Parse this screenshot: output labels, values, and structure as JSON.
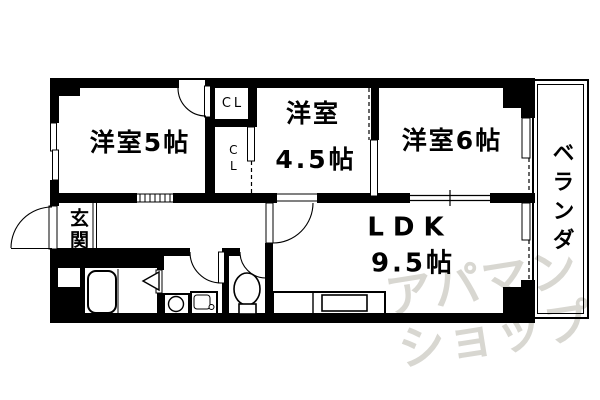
{
  "rooms": {
    "western5": {
      "label": "洋室5帖"
    },
    "western45": {
      "line1": "洋室",
      "line2": "4.5帖"
    },
    "western6": {
      "label": "洋室6帖"
    },
    "ldk": {
      "line1": "LDK",
      "line2": "9.5帖"
    },
    "genkan": {
      "label": "玄関"
    },
    "veranda": {
      "label": "ベランダ"
    },
    "closet_upper": {
      "label": "CL"
    },
    "closet_lower": {
      "label": "CL"
    }
  },
  "watermark": {
    "line1": "アパマン",
    "line2": "ショップ",
    "color": "#d8d7d1"
  },
  "colors": {
    "wall": "#000000",
    "background": "#ffffff",
    "line": "#000000"
  },
  "icons": [
    "bathtub-icon",
    "folding-door-icon",
    "washing-machine-icon",
    "vanity-sink-icon",
    "toilet-icon",
    "kitchen-counter-icon",
    "door-swing-arc",
    "sliding-door",
    "window"
  ]
}
